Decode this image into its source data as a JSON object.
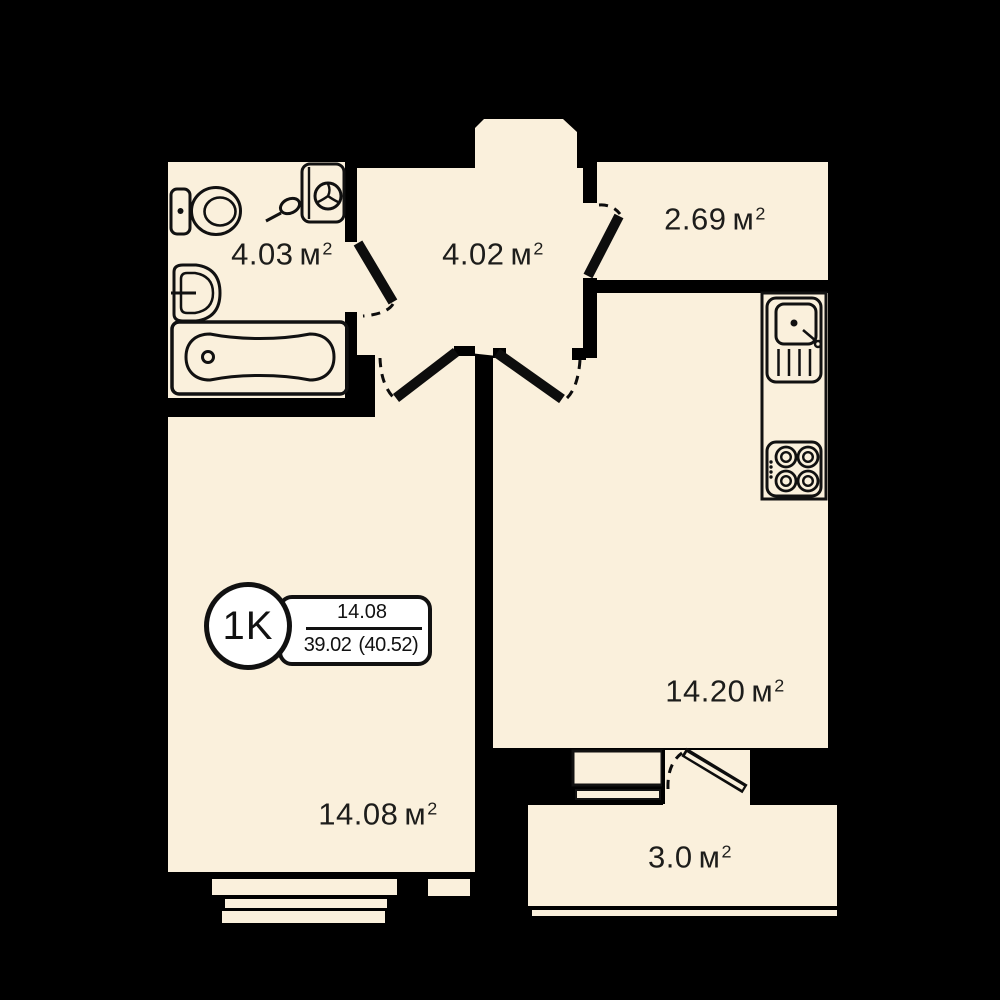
{
  "apartment": {
    "badge": {
      "type_label": "1K",
      "upper_value": "14.08",
      "lower_value": "39.02",
      "lower_value_paren": "(40.52)"
    },
    "area_unit": {
      "base": "м",
      "superscript": "2"
    },
    "rooms": [
      {
        "id": "bathroom",
        "area": "4.03"
      },
      {
        "id": "hallway",
        "area": "4.02"
      },
      {
        "id": "storage",
        "area": "2.69"
      },
      {
        "id": "kitchen-living",
        "area": "14.20"
      },
      {
        "id": "bedroom",
        "area": "14.08"
      },
      {
        "id": "balcony",
        "area": "3.0"
      }
    ],
    "colors": {
      "background": "#000000",
      "room_fill": "#faf0dc",
      "badge_fill": "#ffffff",
      "line": "#111111"
    }
  }
}
